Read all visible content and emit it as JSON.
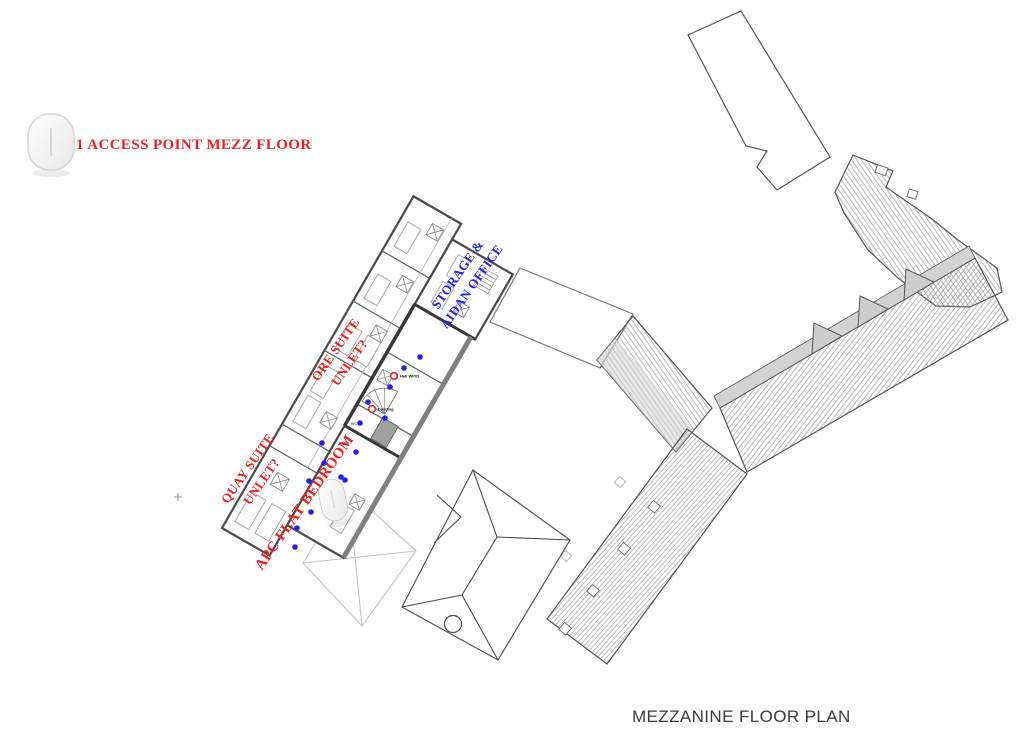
{
  "title": {
    "text": "MEZZANINE FLOOR PLAN"
  },
  "legend": {
    "label": "1 ACCESS POINT MEZZ FLOOR",
    "color": "#f21f1f",
    "device_icon": "access-point-pill"
  },
  "rooms": [
    {
      "id": "storage-aidan-office",
      "line1": "STORAGE &",
      "line2": "AIDAN OFFICE",
      "color": "#2424e8"
    },
    {
      "id": "ore-suite",
      "line1": "ORE SUITE",
      "line2": "UNLET?",
      "color": "#f21f1f"
    },
    {
      "id": "quay-suite",
      "line1": "QUAY SUITE",
      "line2": "UNLET?",
      "color": "#f21f1f"
    },
    {
      "id": "apc-flat-bedroom",
      "line1": "APC FLAT BEDROOM",
      "line2": "",
      "color": "#f21f1f"
    }
  ],
  "markers": {
    "access_points": [
      {
        "x": 394,
        "y": 376,
        "label": "Hall WP02"
      },
      {
        "x": 372,
        "y": 409,
        "label": "Landing"
      }
    ],
    "room_notes": [
      {
        "x": 351,
        "y": 425,
        "text": "WC"
      },
      {
        "x": 339,
        "y": 444,
        "text": "Lobby"
      }
    ],
    "blue_dots": [
      [
        420,
        357
      ],
      [
        404,
        368
      ],
      [
        390,
        387
      ],
      [
        385,
        418
      ],
      [
        368,
        402
      ],
      [
        360,
        423
      ],
      [
        356,
        452
      ],
      [
        345,
        480
      ],
      [
        322,
        443
      ],
      [
        324,
        463
      ],
      [
        309,
        481
      ],
      [
        341,
        477
      ],
      [
        297,
        528
      ],
      [
        295,
        547
      ],
      [
        311,
        512
      ]
    ],
    "dot_color": "#2020f0",
    "ring_color": "#e03430"
  }
}
